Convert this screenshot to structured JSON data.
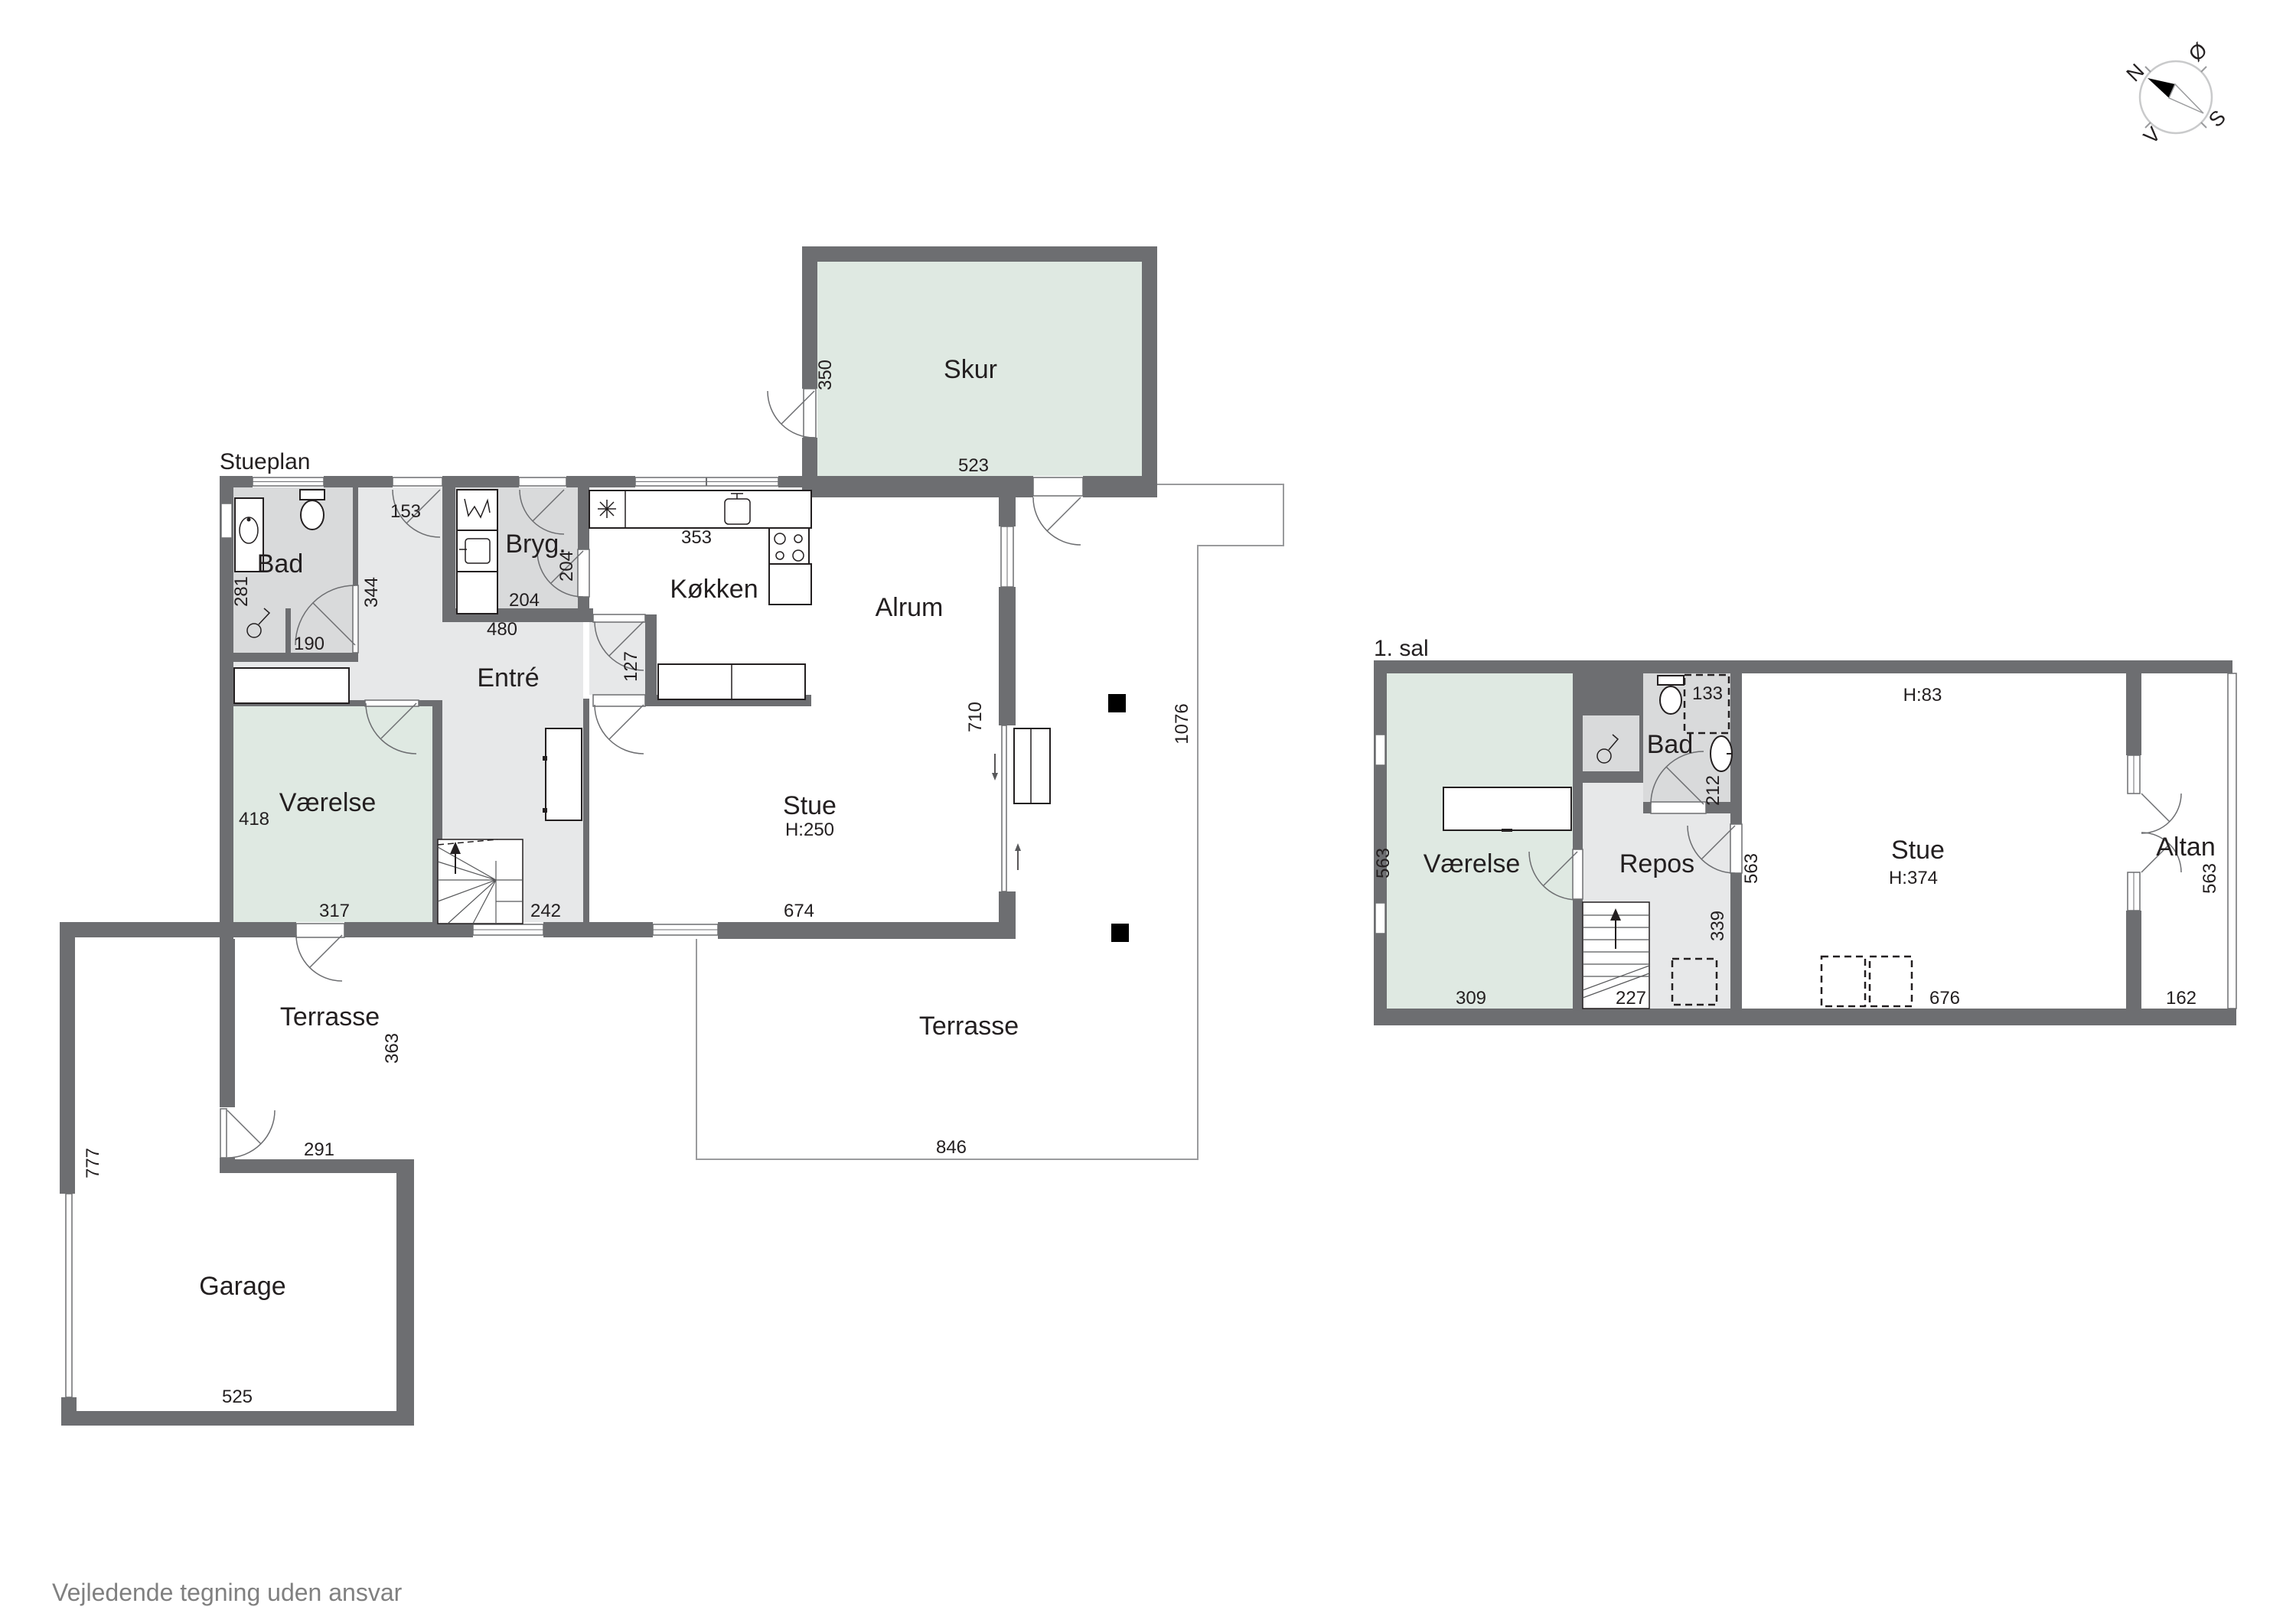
{
  "page": {
    "disclaimer": "Vejledende tegning uden ansvar"
  },
  "compass": {
    "n": "N",
    "e": "Ø",
    "s": "S",
    "w": "V"
  },
  "ground": {
    "title": "Stueplan",
    "rooms": {
      "skur": "Skur",
      "bad": "Bad",
      "bryg": "Bryg.",
      "kokken": "Køkken",
      "alrum": "Alrum",
      "entre": "Entré",
      "vaerelse": "Værelse",
      "stue": "Stue",
      "stue_height": "H:250",
      "terrasse_side": "Terrasse",
      "terrasse_main": "Terrasse",
      "garage": "Garage"
    },
    "dims": {
      "skur_depth": "350",
      "skur_width": "523",
      "door_top": "153",
      "bad_height": "281",
      "entre_height": "344",
      "shower_width": "190",
      "bryg_door": "204",
      "bryg_width": "204",
      "entre_width": "480",
      "kokken_width": "353",
      "passage": "127",
      "vaerelse_height": "418",
      "vaerelse_width": "317",
      "stair_width": "242",
      "stue_width": "674",
      "alrum_height": "710",
      "terrasse_height": "1076",
      "terrasse_width": "846",
      "side_height": "363",
      "side_width": "291",
      "garage_height": "777",
      "garage_width": "525"
    }
  },
  "upper": {
    "title": "1. sal",
    "rooms": {
      "vaerelse": "Værelse",
      "repos": "Repos",
      "bad": "Bad",
      "stue": "Stue",
      "stue_height": "H:374",
      "knee_height": "H:83",
      "altan": "Altan"
    },
    "dims": {
      "vaerelse_height": "563",
      "vaerelse_width": "309",
      "stair_width": "227",
      "shower": "133",
      "bad_height": "212",
      "repos_height": "339",
      "stue_height": "563",
      "stue_width": "676",
      "altan_height": "563",
      "altan_width": "162"
    }
  }
}
